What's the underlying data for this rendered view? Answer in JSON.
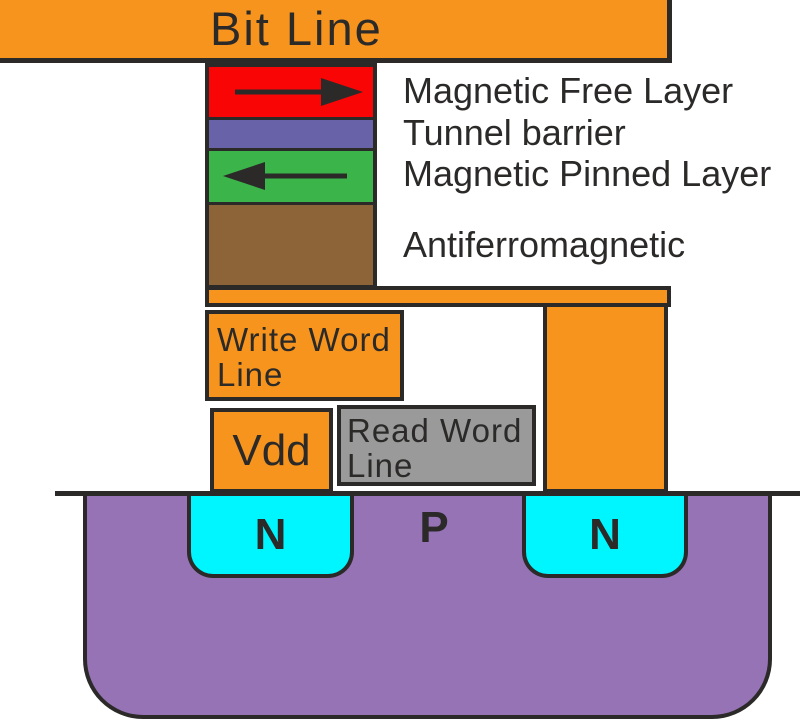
{
  "colors": {
    "orange": "#F7941E",
    "free_layer_red": "#FA0505",
    "tunnel_barrier_purple": "#6862A8",
    "pinned_layer_green": "#3BB44A",
    "antiferromagnetic_brown": "#8D6437",
    "read_word_line_gray": "#9A9A9A",
    "substrate_purple": "#9673B4",
    "n_well_cyan": "#00F6FF",
    "outline": "#2B2A29",
    "background": "#FFFFFF"
  },
  "bit_line": {
    "label": "Bit Line"
  },
  "mtj_stack": {
    "free_layer": {
      "label": "Magnetic Free Layer",
      "magnetization_icon": "arrow-right"
    },
    "tunnel_barrier": {
      "label": "Tunnel barrier"
    },
    "pinned_layer": {
      "label": "Magnetic Pinned Layer",
      "magnetization_icon": "arrow-left"
    },
    "antiferromagnetic": {
      "label": "Antiferromagnetic"
    }
  },
  "write_word_line": {
    "label": "Write Word Line",
    "lines": [
      "Write Word",
      "Line"
    ]
  },
  "vdd": {
    "label": "Vdd"
  },
  "read_word_line": {
    "label": "Read Word Line",
    "lines": [
      "Read Word",
      "Line"
    ]
  },
  "substrate": {
    "source_label": "N",
    "body_label": "P",
    "drain_label": "N"
  }
}
